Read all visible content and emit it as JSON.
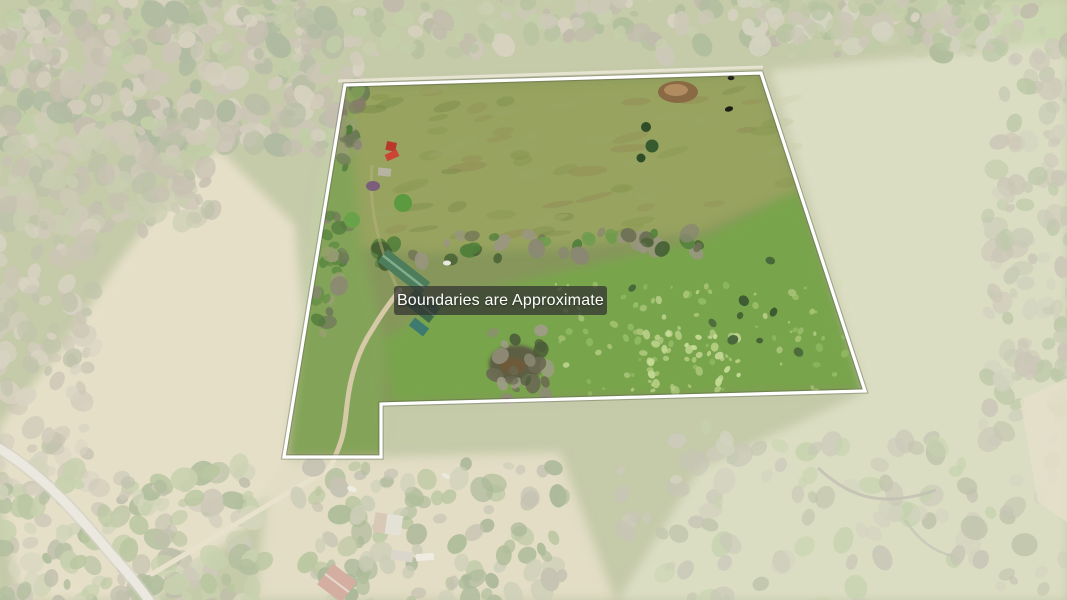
{
  "photo": {
    "description": "Aerial drone photo of a rural property: green pastures, tree lines, farmhouse with green metal roof, pond, driveway, county road and neighboring homestead",
    "boundary": {
      "points": "345,85 761,73 865,391 381,404 381,457 284,457",
      "line_color": "#ffffff"
    },
    "label": {
      "text": "Boundaries are Approximate",
      "text_color": "#ffffff",
      "background": "rgba(48,48,48,0.72)"
    }
  }
}
